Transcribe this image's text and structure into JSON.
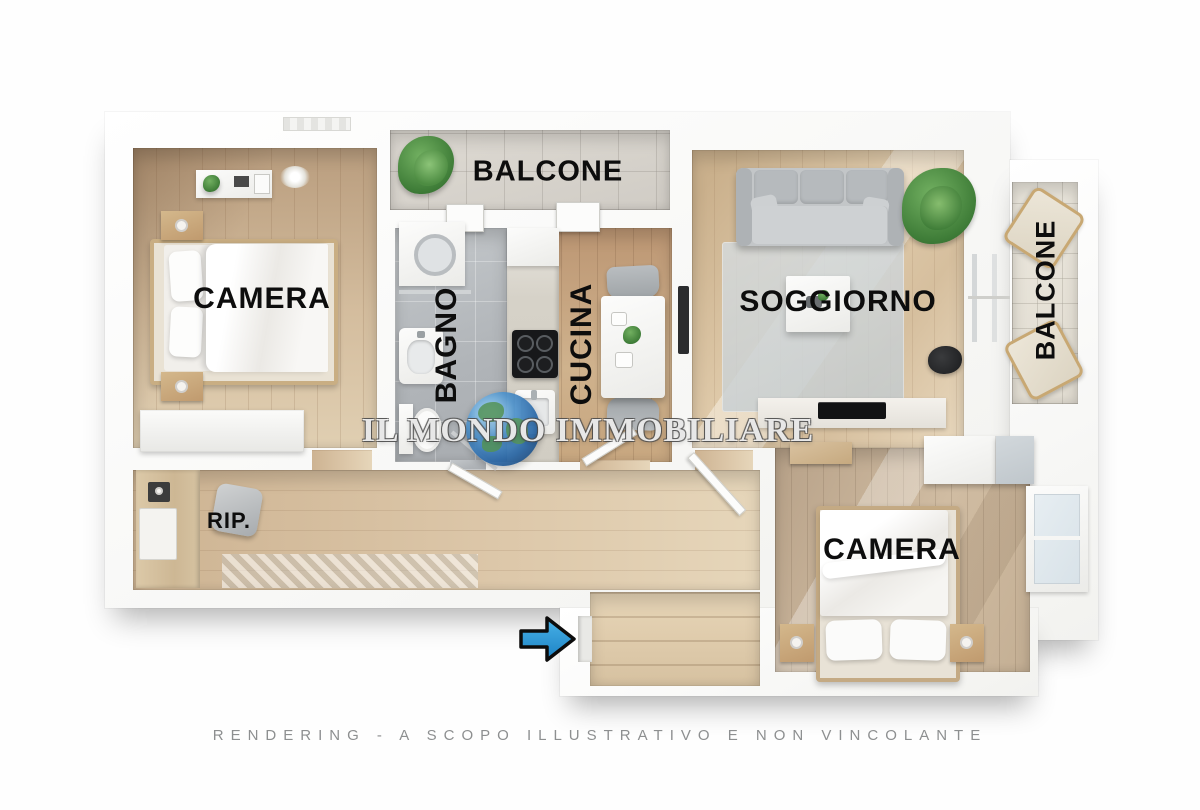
{
  "page": {
    "kind": "3d-floor-plan-rendering",
    "background": "#fefefe"
  },
  "watermark": {
    "brand_text": "IL MONDO IMMOBILIARE"
  },
  "footer": {
    "disclaimer": "RENDERING - A SCOPO ILLUSTRATIVO E NON VINCOLANTE"
  },
  "rooms": {
    "balcone_top": {
      "label": "BALCONE"
    },
    "camera_1": {
      "label": "CAMERA"
    },
    "bagno": {
      "label": "BAGNO"
    },
    "cucina": {
      "label": "CUCINA"
    },
    "soggiorno": {
      "label": "SOGGIORNO"
    },
    "balcone_right": {
      "label": "BALCONE"
    },
    "ripostiglio": {
      "label": "RIP."
    },
    "camera_2": {
      "label": "CAMERA"
    }
  },
  "entrance": {
    "direction": "right",
    "icon": "entrance-arrow-icon"
  },
  "icons": {
    "watermark_globe": "globe-icon",
    "plants": "plant-icon"
  },
  "colors": {
    "arrow_blue": "#2e9ad6",
    "label_black": "#0d0d0d",
    "disclaimer_gray": "#8d8f90",
    "wood_floor": "#d6c0a2",
    "bathroom_tile": "#b4b8bc",
    "wall_white": "#f8f8f7",
    "globe_blue": "#2a67a6",
    "plant_green": "#4e9447"
  }
}
